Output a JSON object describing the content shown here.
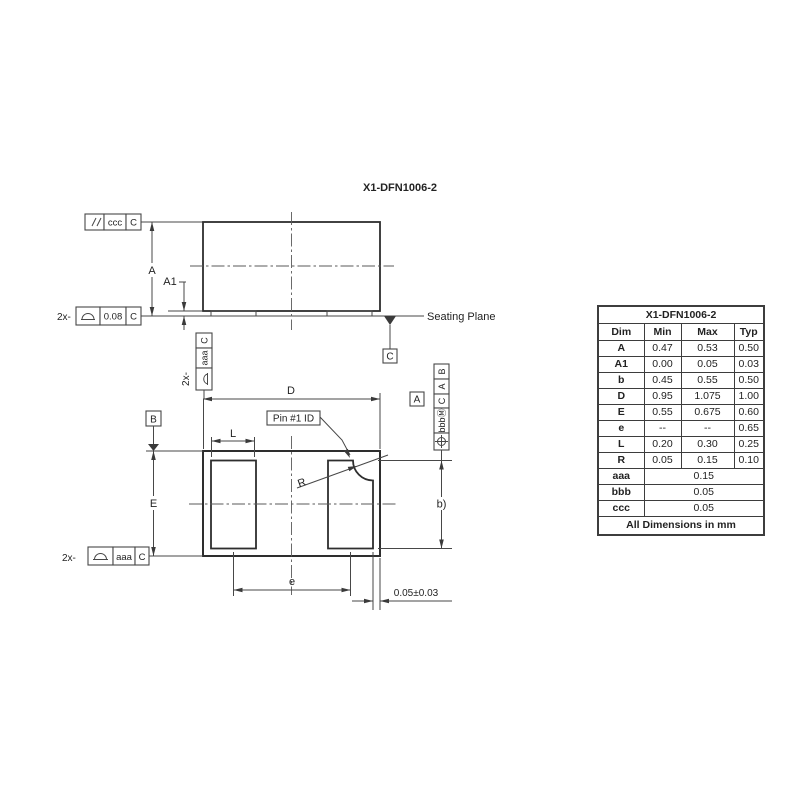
{
  "drawing": {
    "title": "X1-DFN1006-2",
    "labels": {
      "A": "A",
      "A1": "A1",
      "D": "D",
      "E": "E",
      "L": "L",
      "R": "R",
      "e": "e",
      "b": "b)",
      "pin1": "Pin #1 ID",
      "seating": "Seating Plane",
      "offset": "0.05±0.03"
    },
    "datum_boxes": {
      "seating_c": "C",
      "plan_a": "A",
      "plan_b": "B"
    },
    "fcf": {
      "parallelism": {
        "tol": "ccc",
        "datum": "C"
      },
      "profile_top": {
        "count": "2x-",
        "tol": "0.08",
        "datum": "C"
      },
      "profile_side": {
        "count": "2x-",
        "tol": "aaa",
        "datum": "C"
      },
      "profile_bottom": {
        "count": "2x-",
        "tol": "aaa",
        "datum": "C"
      },
      "position": {
        "tol": "bbbⓂ",
        "datum1": "C",
        "datum2": "A",
        "datum3": "B"
      }
    }
  },
  "table": {
    "title": "X1-DFN1006-2",
    "headers": [
      "Dim",
      "Min",
      "Max",
      "Typ"
    ],
    "rows": [
      {
        "dim": "A",
        "min": "0.47",
        "max": "0.53",
        "typ": "0.50"
      },
      {
        "dim": "A1",
        "min": "0.00",
        "max": "0.05",
        "typ": "0.03"
      },
      {
        "dim": "b",
        "min": "0.45",
        "max": "0.55",
        "typ": "0.50"
      },
      {
        "dim": "D",
        "min": "0.95",
        "max": "1.075",
        "typ": "1.00"
      },
      {
        "dim": "E",
        "min": "0.55",
        "max": "0.675",
        "typ": "0.60"
      },
      {
        "dim": "e",
        "min": "--",
        "max": "--",
        "typ": "0.65"
      },
      {
        "dim": "L",
        "min": "0.20",
        "max": "0.30",
        "typ": "0.25"
      },
      {
        "dim": "R",
        "min": "0.05",
        "max": "0.15",
        "typ": "0.10"
      }
    ],
    "tol_rows": [
      {
        "dim": "aaa",
        "value": "0.15"
      },
      {
        "dim": "bbb",
        "value": "0.05"
      },
      {
        "dim": "ccc",
        "value": "0.05"
      }
    ],
    "footer": "All Dimensions in mm"
  },
  "colors": {
    "background": "#ffffff",
    "line": "#3c3c3c",
    "text": "#232323"
  }
}
